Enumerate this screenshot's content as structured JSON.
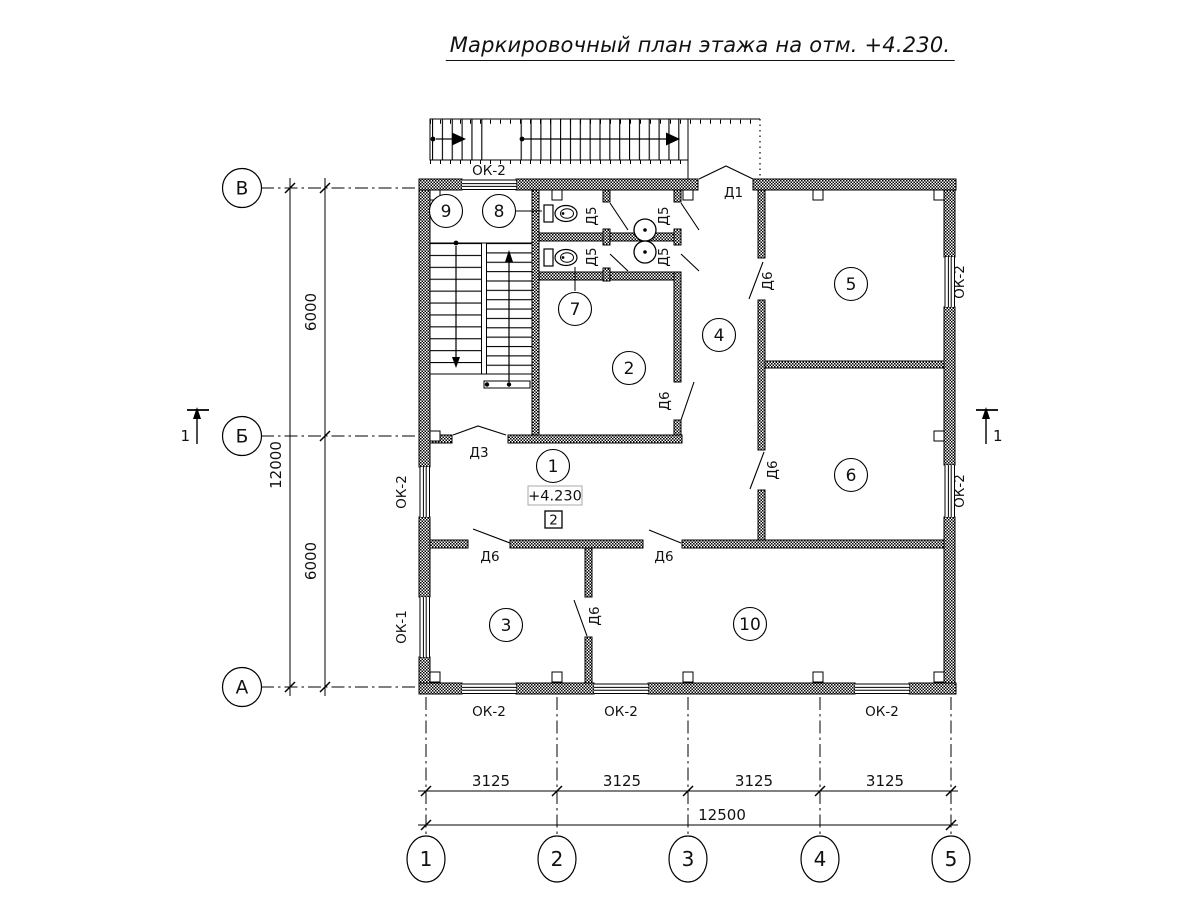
{
  "title": "Маркировочный план этажа на отм. +4.230.",
  "axes": {
    "horizontal": [
      "1",
      "2",
      "3",
      "4",
      "5"
    ],
    "vertical": [
      "В",
      "Б",
      "А"
    ]
  },
  "dimensions": {
    "bottom_segments": [
      "3125",
      "3125",
      "3125",
      "3125"
    ],
    "bottom_total": "12500",
    "left_segments": [
      "6000",
      "6000"
    ],
    "left_total": "12000"
  },
  "rooms": [
    "1",
    "2",
    "3",
    "4",
    "5",
    "6",
    "7",
    "8",
    "9",
    "10"
  ],
  "doors": {
    "d1": "Д1",
    "d3": "Д3",
    "d5": "Д5",
    "d6": "Д6"
  },
  "windows": {
    "ok1": "ОК-1",
    "ok2": "ОК-2"
  },
  "marks": {
    "elevation": "+4.230",
    "floor_type": "2",
    "section": "1"
  },
  "colors": {
    "line": "#000000",
    "background": "#ffffff"
  }
}
